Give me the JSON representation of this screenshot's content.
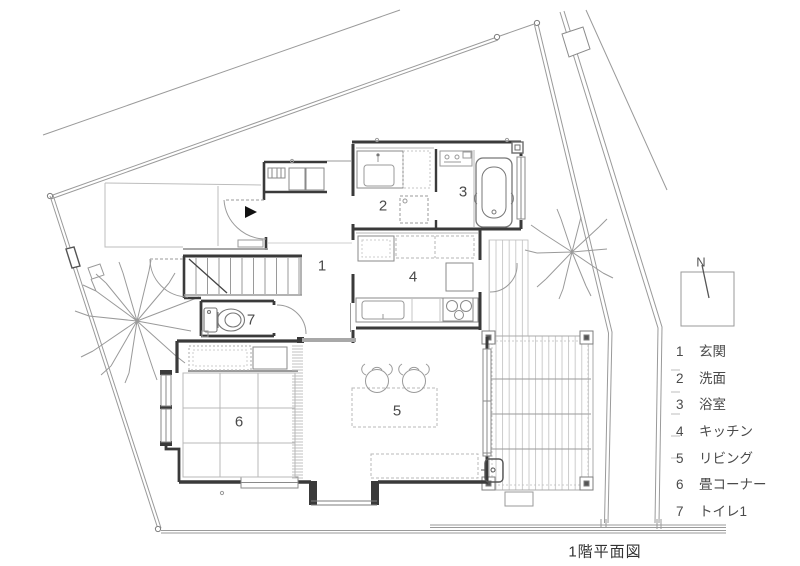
{
  "title": "1階平面図",
  "compass": {
    "label": "N"
  },
  "legend": {
    "items": [
      {
        "num": "1",
        "label": "玄関"
      },
      {
        "num": "2",
        "label": "洗面"
      },
      {
        "num": "3",
        "label": "浴室"
      },
      {
        "num": "4",
        "label": "キッチン"
      },
      {
        "num": "5",
        "label": "リビング"
      },
      {
        "num": "6",
        "label": "畳コーナー"
      },
      {
        "num": "7",
        "label": "トイレ1"
      }
    ]
  },
  "rooms": {
    "genkan": {
      "num": "1"
    },
    "senmen": {
      "num": "2"
    },
    "yokushitsu": {
      "num": "3"
    },
    "kitchen": {
      "num": "4"
    },
    "living": {
      "num": "5"
    },
    "tatami": {
      "num": "6"
    },
    "toilet": {
      "num": "7"
    }
  },
  "colors": {
    "wall": "#3a3a3a",
    "medium_line": "#8a8a8a",
    "light_line": "#b5b5b5",
    "text": "#4a4a4a"
  }
}
